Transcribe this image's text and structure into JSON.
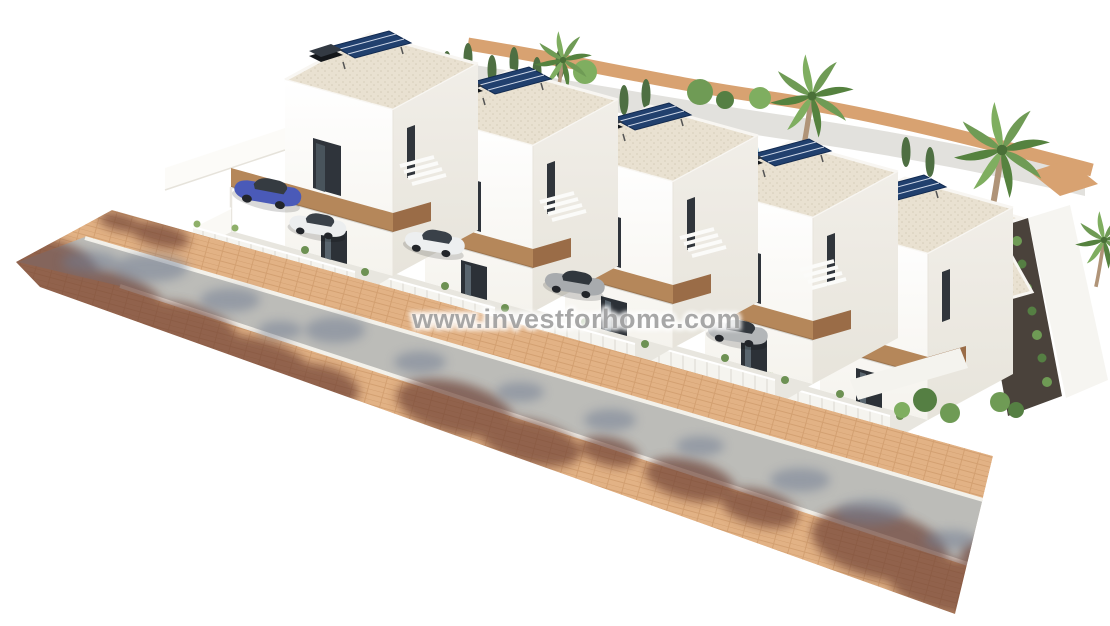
{
  "meta": {
    "type": "3d-architectural-render",
    "canvas_width": 1110,
    "canvas_height": 626,
    "background": "#ffffff",
    "subject": "Aerial 3D render of a row of five modern two-storey white villas with flat gravel roofs, rooftop solar panels, wooden balcony beams, fenced driveways with parked cars, palm trees and a paved street in front"
  },
  "watermark": {
    "text": "www.investforhome.com",
    "color": "#9b9b9b"
  },
  "scene": {
    "villa_count": 5,
    "vehicles": [
      {
        "name": "car-1",
        "color_name": "blue",
        "hex": "#4a5ab8"
      },
      {
        "name": "car-2",
        "color_name": "white",
        "hex": "#eceeef"
      },
      {
        "name": "car-3",
        "color_name": "white",
        "hex": "#edeff0"
      },
      {
        "name": "car-4",
        "color_name": "gray",
        "hex": "#a8abae"
      },
      {
        "name": "car-5",
        "color_name": "gray",
        "hex": "#b3b6b8"
      }
    ],
    "vegetation": {
      "palm_trees": 4,
      "cypresses": 10,
      "shrubs": "hedge and bush clusters along walls and garden bed"
    },
    "street": {
      "surface": "asphalt",
      "sidewalks": "terracotta pavers on both sides",
      "shadows": "tree-canopy shadows across road and sidewalks"
    }
  },
  "colors": {
    "wall_white": "#fcfcfa",
    "wall_shade": "#efece5",
    "roof_gravel": "#e9e1d1",
    "parapet": "#f8f6f2",
    "wood_beam": "#b5875a",
    "wood_beam_dark": "#9a6c47",
    "solar_panel": "#21406e",
    "glass_dark": "#2f343b",
    "fence": "#f5f4ef",
    "driveway": "#e8e6df",
    "asphalt": "#bcbcb8",
    "sidewalk": "#e2b285",
    "curb": "#f3f1ea",
    "rear_path": "#d8a271",
    "plateau": "#e2e1dd",
    "garden_gravel": "#4a423b",
    "green_dark": "#4e6f42",
    "green_mid": "#6f9b55",
    "green_light": "#8fb06a",
    "trunk": "#b09478",
    "pool": "#4f93b8",
    "shadow_warm": "#6b3d33",
    "shadow_cool": "#6f7b92"
  }
}
